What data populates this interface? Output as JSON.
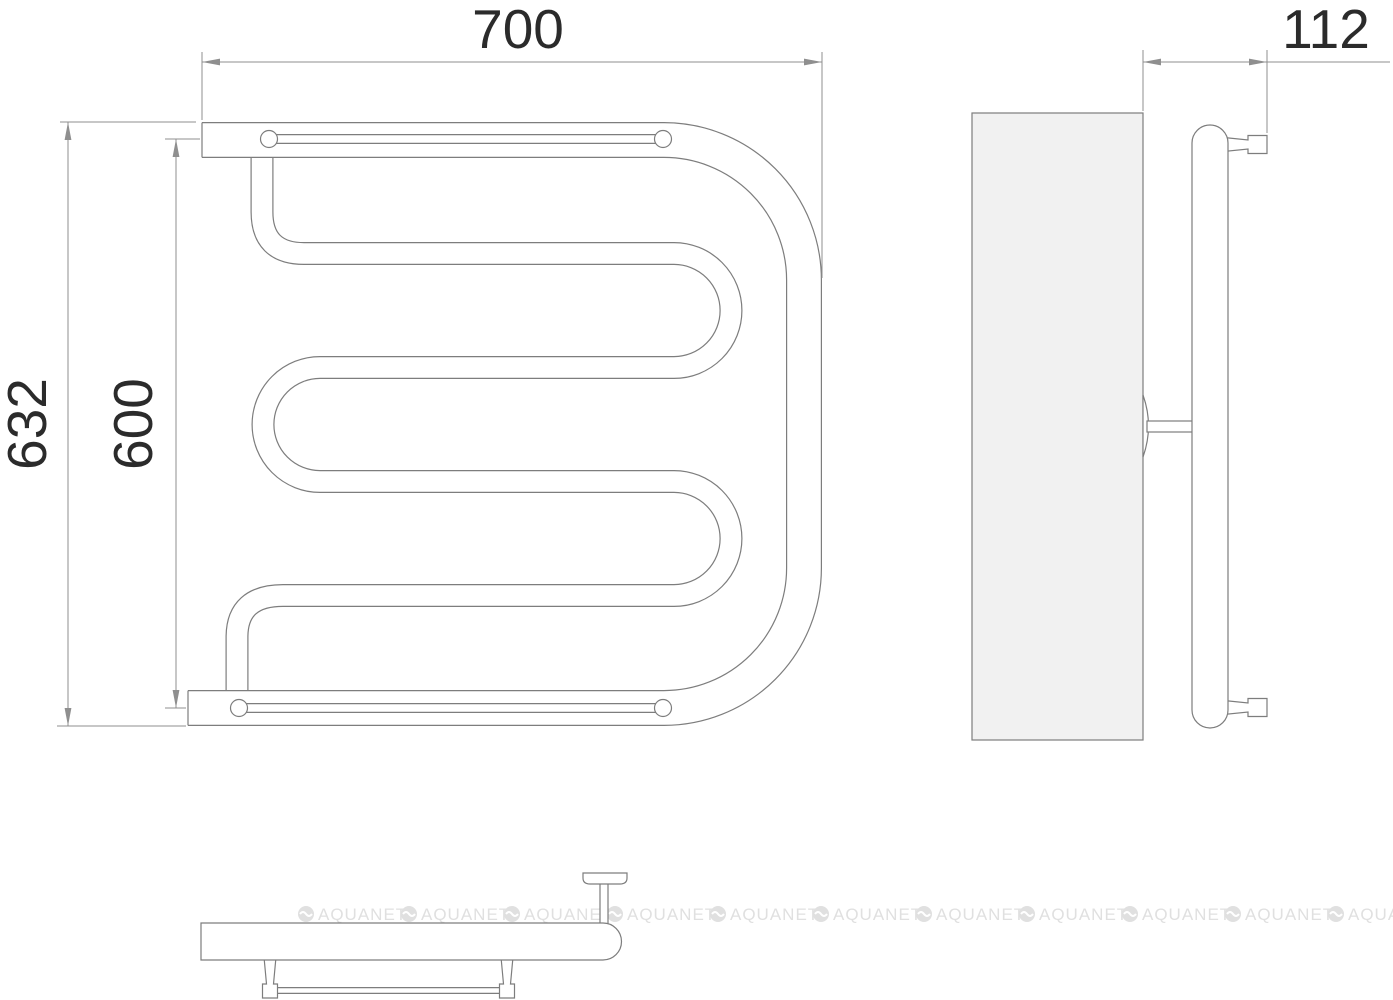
{
  "drawing": {
    "type": "towel-rail-technical-drawing",
    "dimensions": {
      "width": "700",
      "depth": "112",
      "overall_height": "632",
      "axis_height": "600"
    },
    "watermark": {
      "text": "AQUANET",
      "repeat": 11
    },
    "colors": {
      "outline": "#7d7d7d",
      "dimension_lines": "#8f8f8f",
      "dimension_text": "#2b2b2b",
      "wall_panel_fill": "#f1f1f1",
      "watermark": "#e0e0e0",
      "background": "#ffffff"
    }
  }
}
